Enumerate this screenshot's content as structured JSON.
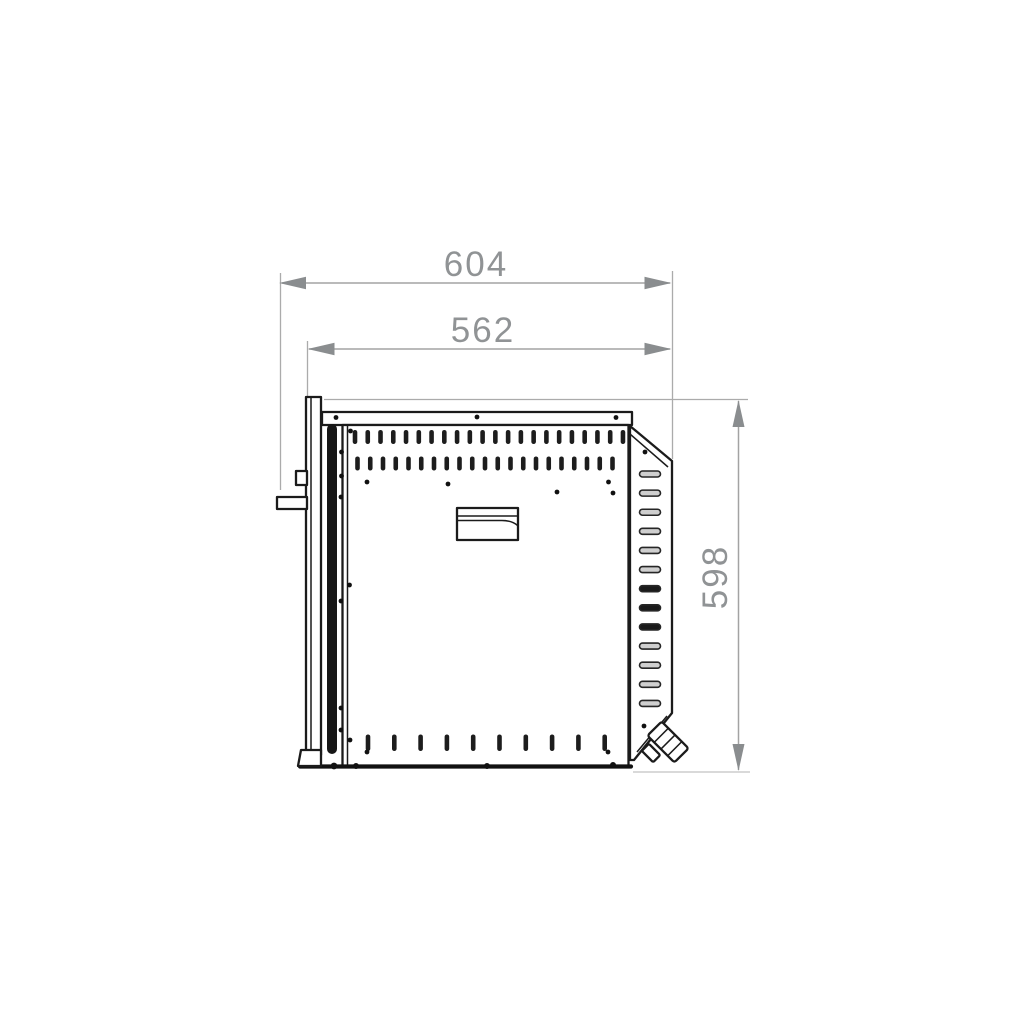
{
  "meta": {
    "title": "Appliance side-view installation drawing",
    "units": "mm",
    "background_color": "#ffffff",
    "drawing_line_color": "#1b1b1b",
    "dimension_color": "#909395"
  },
  "dimensions": {
    "overall_depth": {
      "label": "604",
      "orientation": "horizontal"
    },
    "body_depth": {
      "label": "562",
      "orientation": "horizontal"
    },
    "height": {
      "label": "598",
      "orientation": "vertical"
    }
  }
}
